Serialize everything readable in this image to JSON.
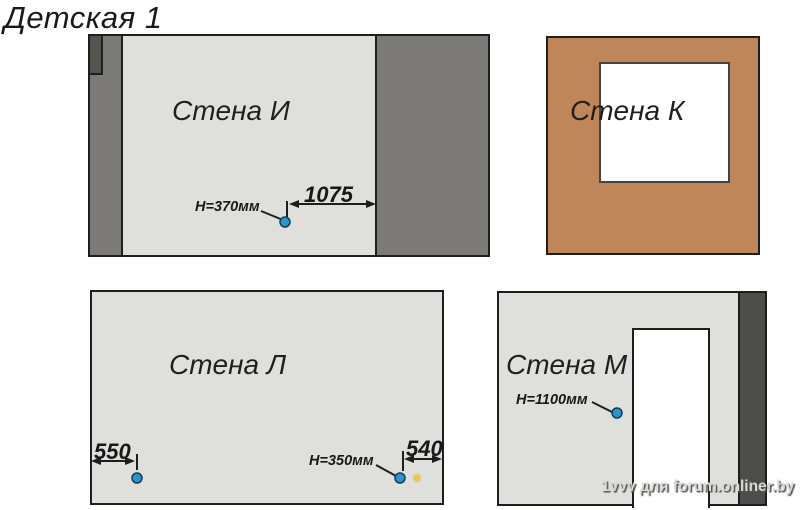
{
  "title": "Детская 1",
  "walls": {
    "i": {
      "label": "Стена И",
      "outlet_height_label": "H=370мм",
      "dim_to_wall_label": "1075"
    },
    "k": {
      "label": "Стена К"
    },
    "l": {
      "label": "Стена Л",
      "dim_left_label": "550",
      "outlet_height_label": "H=350мм",
      "dim_right_label": "540"
    },
    "m": {
      "label": "Стена М",
      "outlet_height_label": "H=1100мм"
    }
  },
  "watermark": "1vvv для forum.onliner.by",
  "colors": {
    "wall_light": "#dfdfdc",
    "wall_medium_gray": "#7b7a76",
    "wall_dark_gray": "#55534e",
    "wall_brown": "#bf8659",
    "window_white": "#ffffff",
    "outlet_blue": "#2b95ce",
    "outlet_yellow": "#ebc74b",
    "line_black": "#1e1e1e"
  }
}
